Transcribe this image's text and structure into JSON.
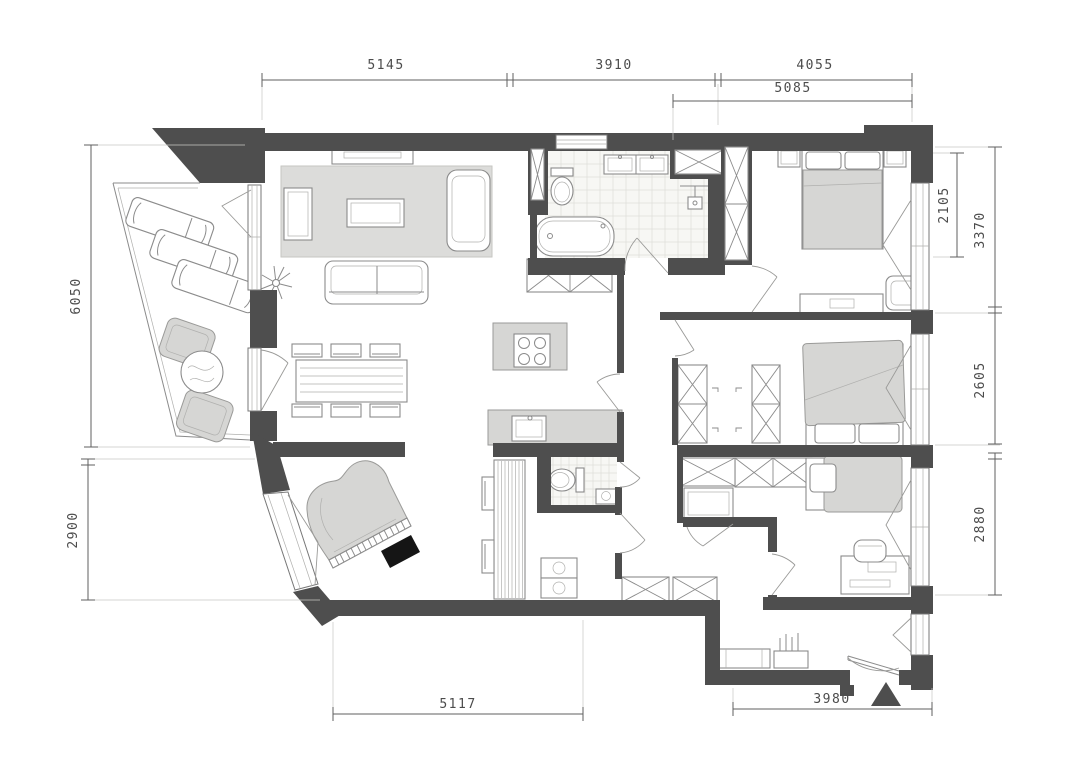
{
  "plan": {
    "colors": {
      "wall": "#4e4e4e",
      "furniture_line": "#8b8b8b",
      "light_gray_fill": "#d6d6d4",
      "tile_floor": "#f7f7f4",
      "background": "#ffffff",
      "dimension_text": "#4c4c4c"
    },
    "dimensions": {
      "top": [
        {
          "label": "5145"
        },
        {
          "label": "3910"
        },
        {
          "label": "4055"
        }
      ],
      "top_secondary": {
        "label": "5085"
      },
      "left": [
        {
          "label": "6050"
        },
        {
          "label": "2900"
        }
      ],
      "right_inner": {
        "label": "2105"
      },
      "right": [
        {
          "label": "3370"
        },
        {
          "label": "2605"
        },
        {
          "label": "2880"
        }
      ],
      "bottom": [
        {
          "label": "5117"
        },
        {
          "label": "3980"
        }
      ]
    },
    "rooms": [
      {
        "name": "balcony"
      },
      {
        "name": "living-room"
      },
      {
        "name": "dining-area"
      },
      {
        "name": "kitchen"
      },
      {
        "name": "bathroom"
      },
      {
        "name": "wc"
      },
      {
        "name": "laundry"
      },
      {
        "name": "hallway"
      },
      {
        "name": "master-bedroom"
      },
      {
        "name": "middle-bedroom"
      },
      {
        "name": "third-bedroom"
      },
      {
        "name": "piano-room"
      },
      {
        "name": "entry-hall"
      }
    ],
    "furniture_icons": [
      "lounger",
      "armchair",
      "round-table",
      "plant",
      "rug",
      "sofa",
      "coffee-table",
      "tv-console",
      "side-table",
      "dining-table",
      "dining-chair",
      "kitchen-island",
      "cooktop",
      "kitchen-counter",
      "kitchen-sink",
      "tall-cabinet",
      "wardrobe",
      "toilet",
      "double-washbasin",
      "bathtub",
      "shower",
      "double-bed",
      "single-bed",
      "nightstand",
      "dresser",
      "desk",
      "desk-chair",
      "grand-piano",
      "piano-bench",
      "washer-dryer",
      "pantry-closet",
      "entry-bench",
      "entrance-door",
      "entrance-marker"
    ]
  }
}
